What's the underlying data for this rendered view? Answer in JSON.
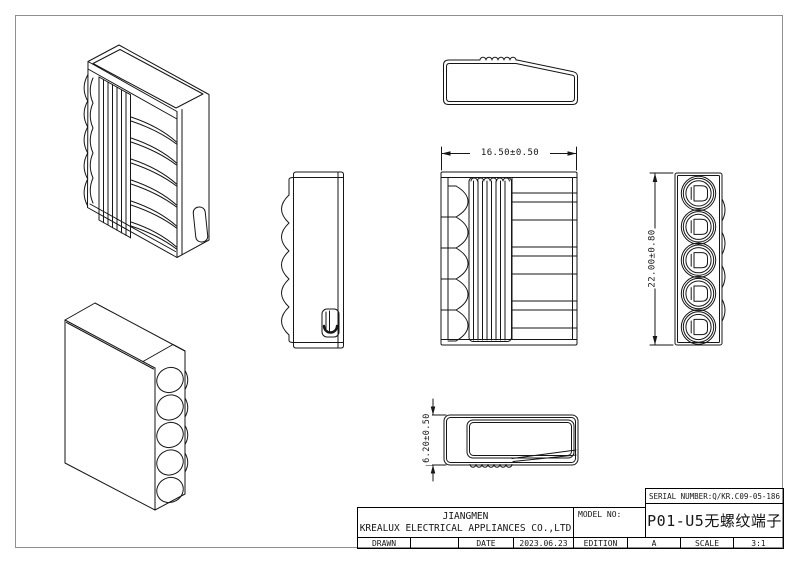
{
  "colors": {
    "background": "#ffffff",
    "frame": "#8f8f8f",
    "line": "#161616",
    "text": "#161616"
  },
  "dimensions": {
    "width_label": "16.50±0.50",
    "height_label": "22.00±0.80",
    "depth_label": "6.20±0.50"
  },
  "title_block": {
    "serial_number": "SERIAL NUMBER:Q/KR.C09-05-186",
    "company_line1": "JIANGMEN",
    "company_line2": "KREALUX ELECTRICAL APPLIANCES CO.,LTD",
    "model_no_label": "MODEL NO:",
    "model_no_value": "P01-U5无螺纹端子",
    "drawn_label": "DRAWN",
    "drawn_value": "",
    "date_label": "DATE",
    "date_value": "2023.06.23",
    "edition_label": "EDITION",
    "edition_value": "A",
    "scale_label": "SCALE",
    "scale_value": "3:1"
  }
}
